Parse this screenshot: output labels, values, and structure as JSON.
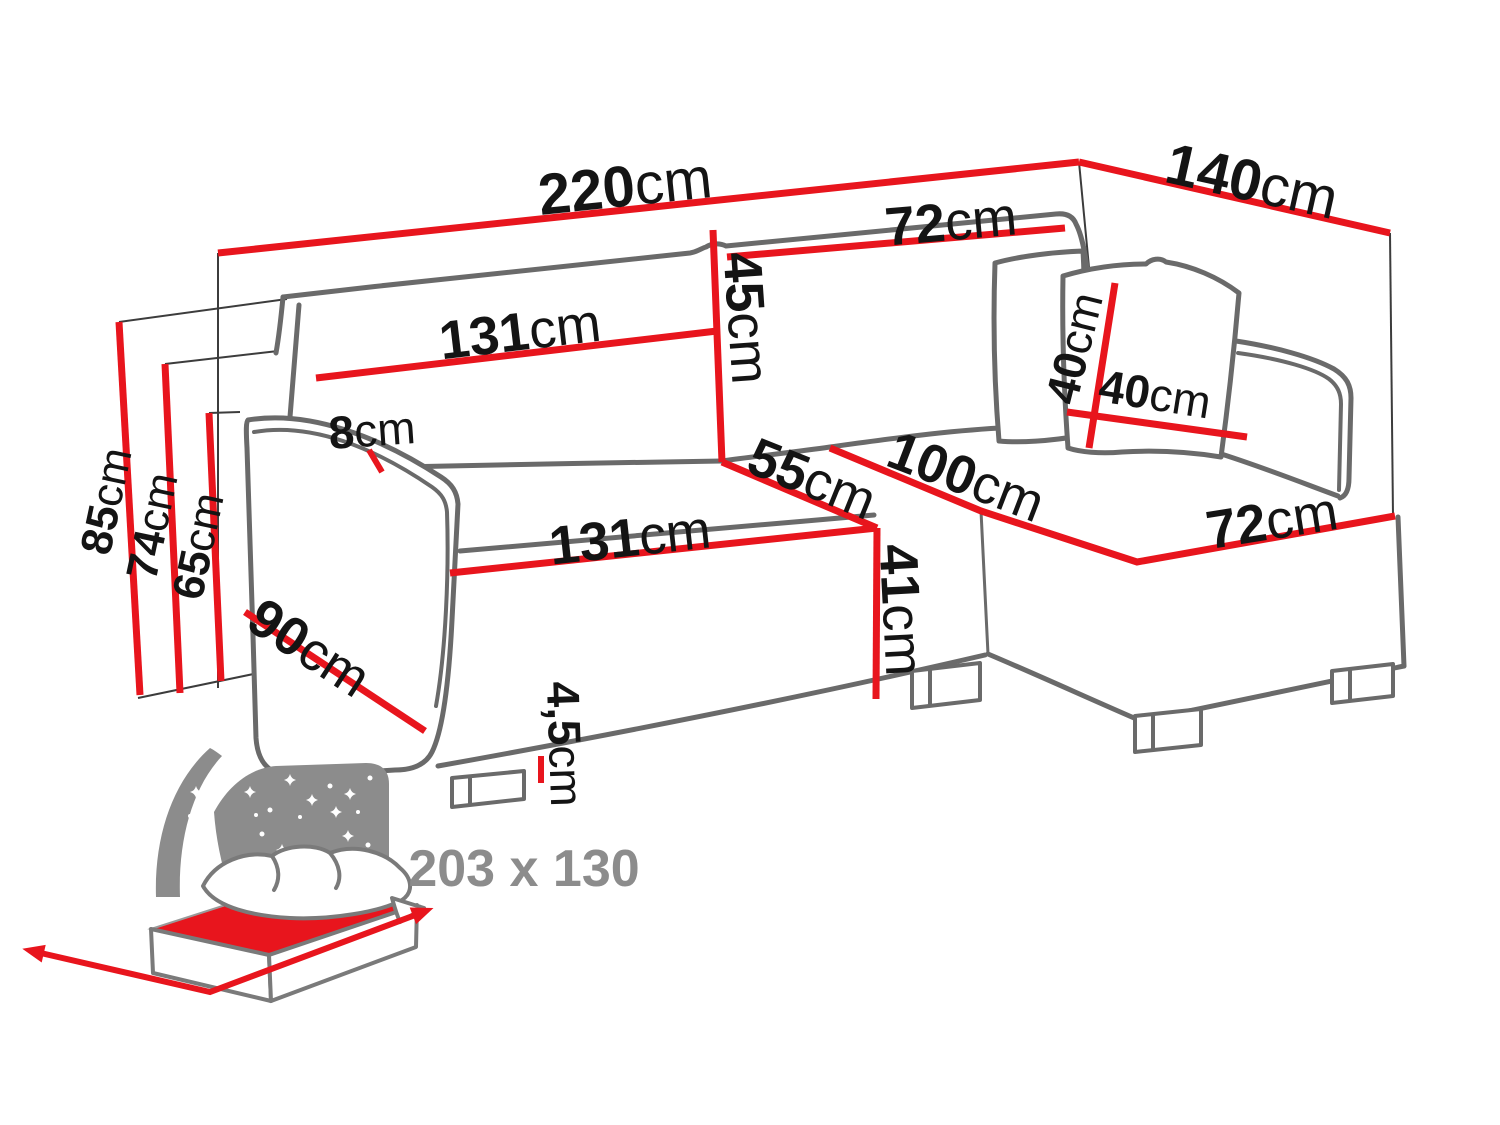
{
  "diagram": {
    "title": "corner-sofa-dimensions",
    "unit": "cm",
    "labels": {
      "total_width": {
        "num": "220",
        "unit": "cm"
      },
      "total_depth": {
        "num": "140",
        "unit": "cm"
      },
      "backrest_width": {
        "num": "131",
        "unit": "cm"
      },
      "backrest_height": {
        "num": "45",
        "unit": "cm"
      },
      "backrest_right_width": {
        "num": "72",
        "unit": "cm"
      },
      "pillow_height": {
        "num": "40",
        "unit": "cm"
      },
      "pillow_width": {
        "num": "40",
        "unit": "cm"
      },
      "seat_seam_depth": {
        "num": "55",
        "unit": "cm"
      },
      "chaise_length": {
        "num": "100",
        "unit": "cm"
      },
      "chaise_front_width": {
        "num": "72",
        "unit": "cm"
      },
      "armrest_top_width": {
        "num": "8",
        "unit": "cm"
      },
      "seat_front_width": {
        "num": "131",
        "unit": "cm"
      },
      "seat_height": {
        "num": "41",
        "unit": "cm"
      },
      "armrest_depth": {
        "num": "90",
        "unit": "cm"
      },
      "height_total": {
        "num": "85",
        "unit": "cm"
      },
      "height_armrest": {
        "num": "74",
        "unit": "cm"
      },
      "height_backrest_low": {
        "num": "65",
        "unit": "cm"
      },
      "leg_height": {
        "num": "4,5",
        "unit": "cm"
      },
      "sleeping_area": "203 x 130"
    },
    "colors": {
      "dimension_red": "#e8151d",
      "outline_gray": "#6a6a6a",
      "helper_line": "#3c3c3c",
      "text_black": "#141414",
      "muted_gray": "#8c8c8c"
    },
    "icons": [
      "bed-icon",
      "star-icon",
      "arrow-icon"
    ]
  }
}
